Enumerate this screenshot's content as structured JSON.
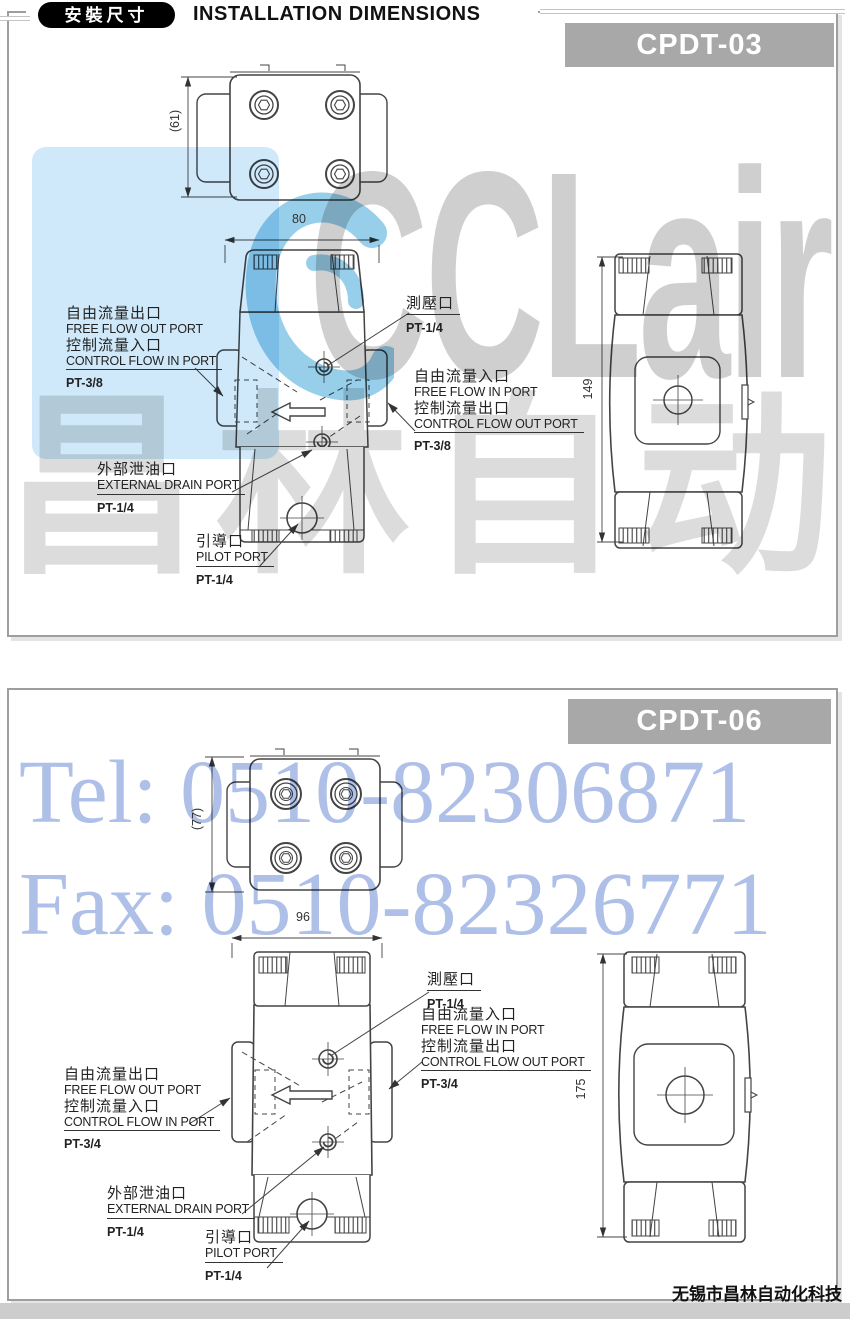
{
  "header": {
    "badge": "安裝尺寸",
    "title": "INSTALLATION DIMENSIONS"
  },
  "footer": {
    "company": "无锡市昌林自动化科技"
  },
  "watermarks": {
    "brand": "CCLair",
    "brand_cn": "昌林自动化",
    "tel": "Tel: 0510-82306871",
    "fax": "Fax: 0510-82326771"
  },
  "colors": {
    "model_tag_bg": "#a8a8a8",
    "drawing_line": "#444444",
    "watermark_blue_patch": "#cfe9fa",
    "watermark_logo_blue": "#2f9fd6",
    "watermark_text_blue": "#a5b8e6",
    "watermark_gray": "#c7c7c7"
  },
  "panels": [
    {
      "model": "CPDT-03",
      "dims": {
        "depth": "(61)",
        "width": "80",
        "height": "149"
      },
      "ports": {
        "gauge": {
          "cn": "測壓口",
          "size": "PT-1/4"
        },
        "free_in": {
          "cn1": "自由流量入口",
          "en1": "FREE FLOW IN PORT",
          "cn2": "控制流量出口",
          "en2": "CONTROL FLOW OUT PORT",
          "size": "PT-3/8"
        },
        "free_out": {
          "cn1": "自由流量出口",
          "en1": "FREE FLOW OUT PORT",
          "cn2": "控制流量入口",
          "en2": "CONTROL FLOW IN PORT",
          "size": "PT-3/8"
        },
        "drain": {
          "cn": "外部泄油口",
          "en": "EXTERNAL DRAIN PORT",
          "size": "PT-1/4"
        },
        "pilot": {
          "cn": "引導口",
          "en": "PILOT PORT",
          "size": "PT-1/4"
        }
      }
    },
    {
      "model": "CPDT-06",
      "dims": {
        "depth": "(77)",
        "width": "96",
        "height": "175"
      },
      "ports": {
        "gauge": {
          "cn": "測壓口",
          "size": "PT-1/4"
        },
        "free_in": {
          "cn1": "自由流量入口",
          "en1": "FREE FLOW IN PORT",
          "cn2": "控制流量出口",
          "en2": "CONTROL FLOW OUT PORT",
          "size": "PT-3/4"
        },
        "free_out": {
          "cn1": "自由流量出口",
          "en1": "FREE FLOW OUT PORT",
          "cn2": "控制流量入口",
          "en2": "CONTROL FLOW IN PORT",
          "size": "PT-3/4"
        },
        "drain": {
          "cn": "外部泄油口",
          "en": "EXTERNAL DRAIN PORT",
          "size": "PT-1/4"
        },
        "pilot": {
          "cn": "引導口",
          "en": "PILOT PORT",
          "size": "PT-1/4"
        }
      }
    }
  ]
}
